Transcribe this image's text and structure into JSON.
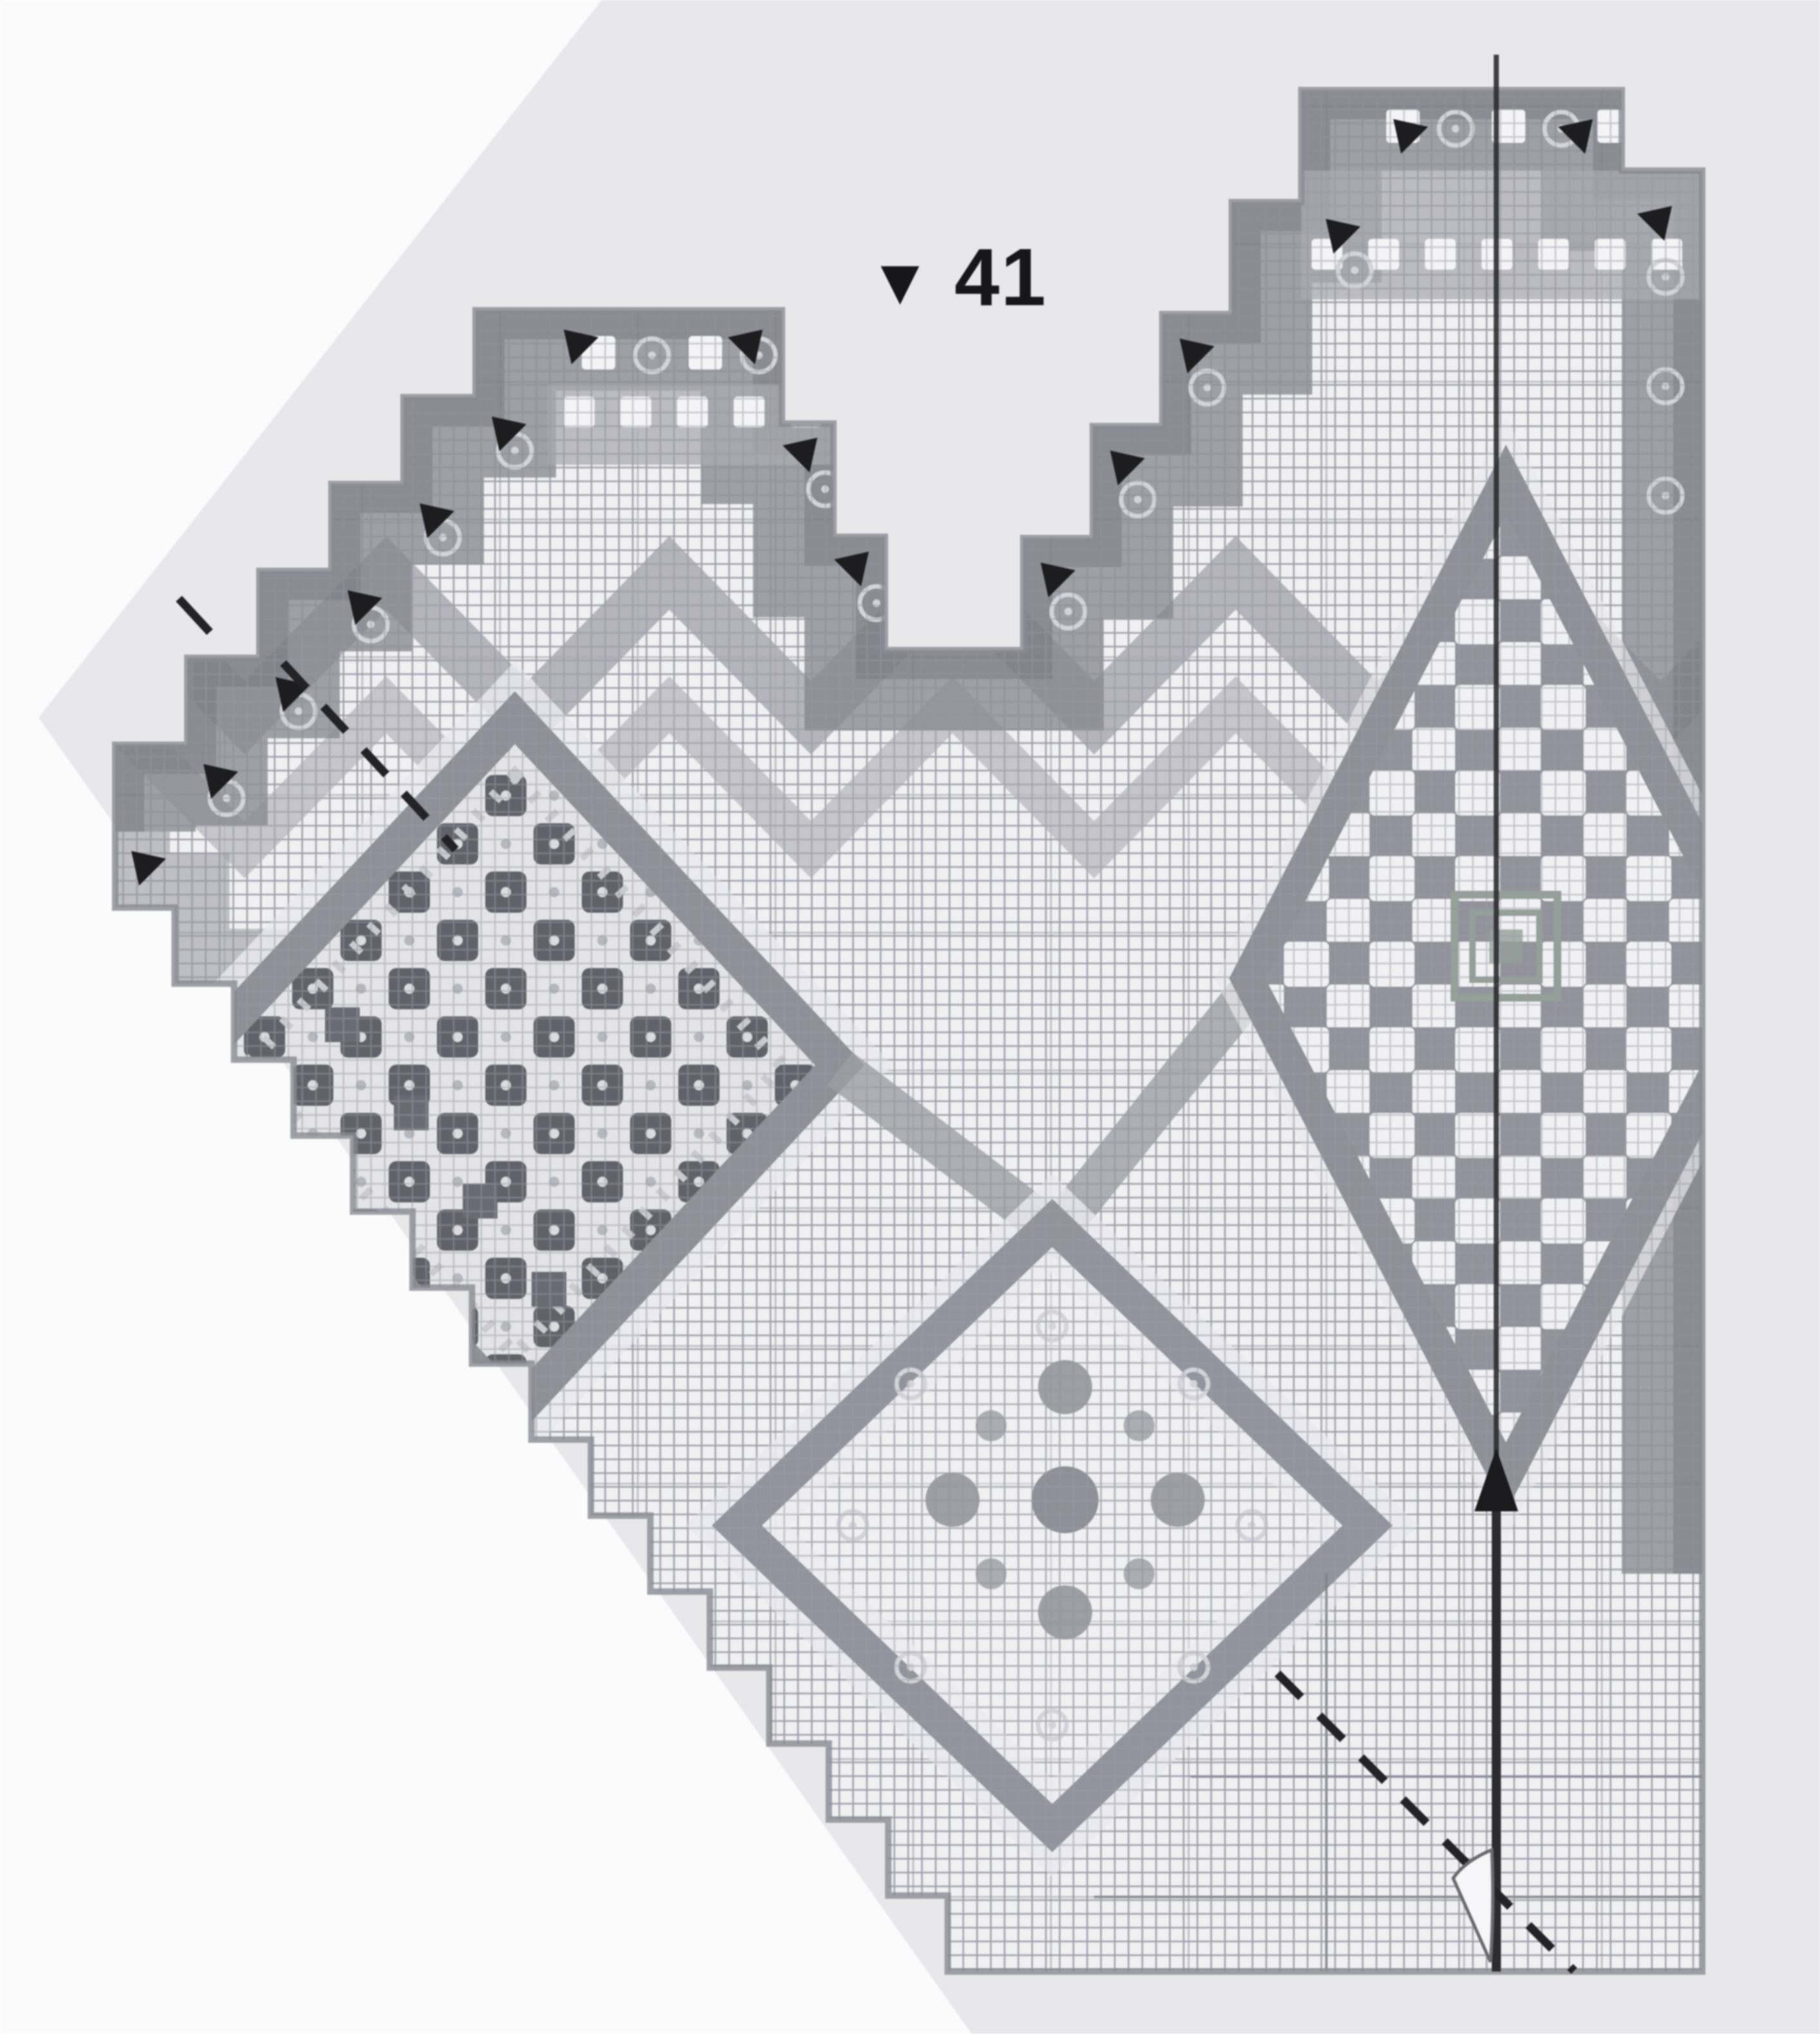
{
  "page": {
    "background": "#fbfbfc",
    "paper": "#e8e8eb"
  },
  "chart": {
    "marker": "▼",
    "row_number": "41",
    "palette": {
      "cell_bg": "#f0f0f3",
      "cell_line": "#a7a7af",
      "mesh_line": "#989aa2",
      "major_line": "#7f7f87",
      "band_dark": "#84848c",
      "band_mid": "#9d9da5",
      "band_inner": "#a9a9b0",
      "edge_line": "#8a8a92",
      "chevron_a": "#aaa9b1",
      "chevron_b": "#b8b7be",
      "checker_dark": "#61616a",
      "checker_light": "#e4e4e8",
      "open_bg": "#92929b",
      "open_white": "#f1f1f4",
      "motif": "#8f8f98",
      "halo": "#e9e9ee",
      "rosette": "#d3d3d9",
      "white_window": "#f4f4f7",
      "dark_square": "#6a6a73",
      "center_accent": "#94a098",
      "annotation": "#232327",
      "axis": "#2c2c30"
    }
  },
  "annotations": {
    "row_marker": {
      "icon": "triangle-down-icon",
      "value": "41"
    },
    "center_axis": {
      "icon": "arrow-up-icon",
      "style": "solid-vertical"
    },
    "fold_lines": {
      "style": "dashed-diagonal"
    },
    "angle_symbol": {
      "icon": "angle-wedge-icon"
    },
    "step_arrows": {
      "icon": "direction-arrow-icon"
    }
  }
}
